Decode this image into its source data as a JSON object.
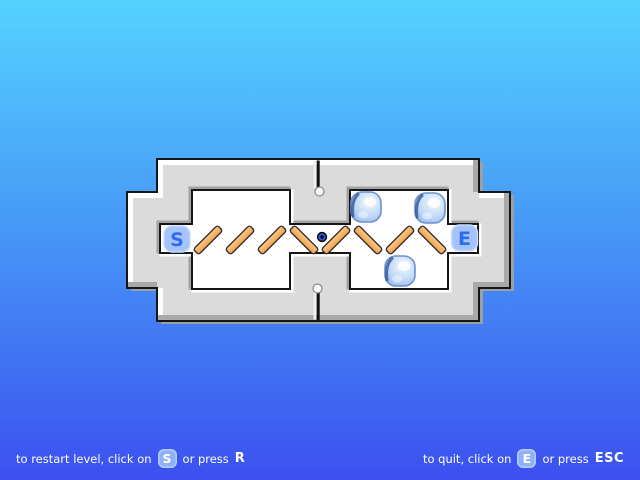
{
  "background": {
    "top": "#55D2FF",
    "bottom": "#3C50F0"
  },
  "board": {
    "wall_color": "#DBDBDB",
    "floor_color": "#FFFFFF",
    "marker_bg": "#A6C3FB",
    "marker_text_color": "#2D6CEF",
    "start_marker": {
      "label": "S",
      "x": 177,
      "y": 239
    },
    "end_marker": {
      "label": "E",
      "x": 464.5,
      "y": 238
    },
    "mirror_color": "#F5A95C",
    "mirrors": [
      {
        "x": 208,
        "y": 240,
        "orientation": "/"
      },
      {
        "x": 240,
        "y": 240,
        "orientation": "/"
      },
      {
        "x": 272,
        "y": 240,
        "orientation": "/"
      },
      {
        "x": 304,
        "y": 240,
        "orientation": "\\"
      },
      {
        "x": 336,
        "y": 240,
        "orientation": "/"
      },
      {
        "x": 368,
        "y": 240,
        "orientation": "\\"
      },
      {
        "x": 400,
        "y": 240,
        "orientation": "/"
      },
      {
        "x": 432,
        "y": 240,
        "orientation": "\\"
      }
    ],
    "ball": {
      "x": 322,
      "y": 237,
      "color": "#2B5BE8"
    },
    "ice_cubes": [
      {
        "x": 366,
        "y": 207
      },
      {
        "x": 430,
        "y": 208
      },
      {
        "x": 400,
        "y": 271
      }
    ]
  },
  "footer": {
    "restart": {
      "text_before": "to restart level, click on",
      "badge": "S",
      "text_after": "or press",
      "key": "R"
    },
    "quit": {
      "text_before": "to quit, click on",
      "badge": "E",
      "text_after": "or press",
      "key": "ESC"
    }
  }
}
